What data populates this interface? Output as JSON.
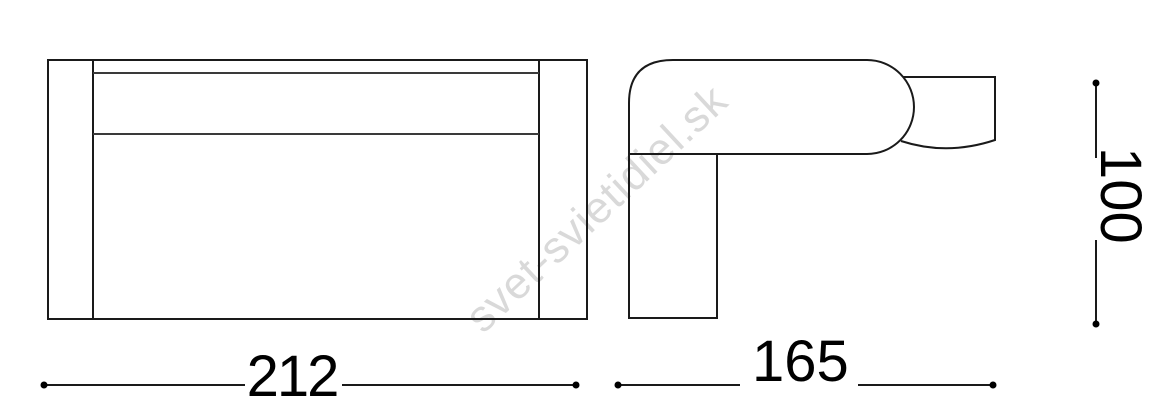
{
  "figure": {
    "description": "Technical dimension drawing of a wall light fixture, front view and side view",
    "line_color": "#1a1a1a",
    "background_color": "#ffffff"
  },
  "watermark": {
    "text": "svet-svietidiel.sk",
    "color": "#d9d9d9"
  },
  "dimensions": {
    "width": {
      "label": "212",
      "orientation": "horizontal",
      "view": "front"
    },
    "depth": {
      "label": "165",
      "orientation": "horizontal",
      "view": "side"
    },
    "height": {
      "label": "100",
      "orientation": "vertical-rotated-90cw",
      "view": "side"
    }
  }
}
